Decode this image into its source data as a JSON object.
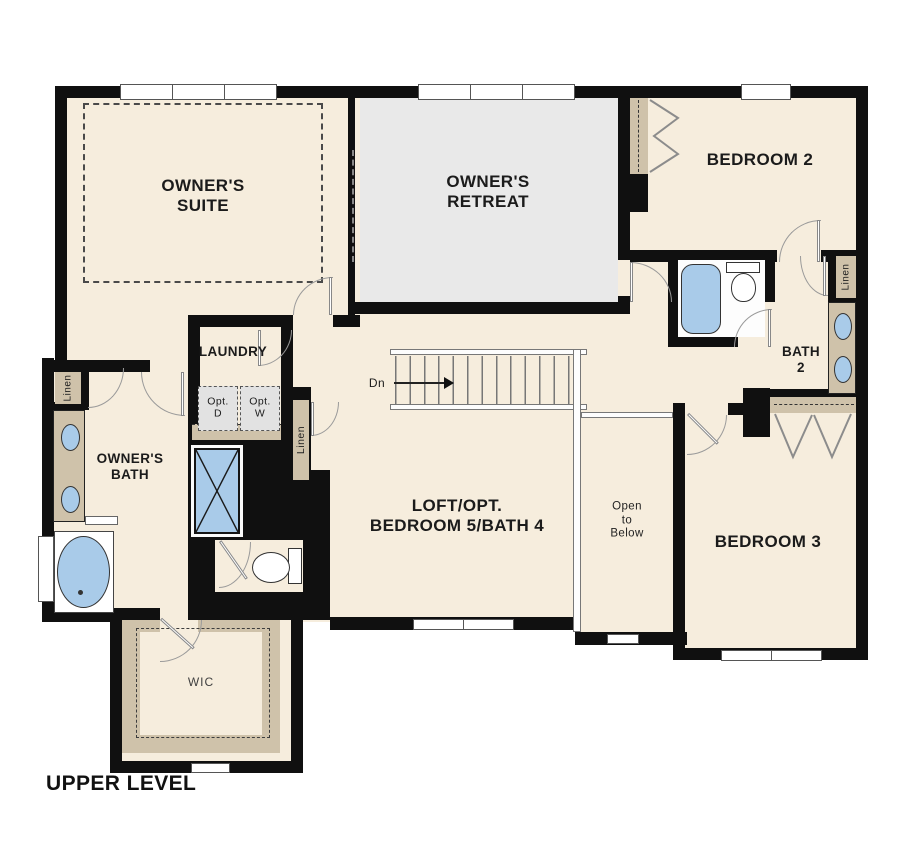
{
  "title": "UPPER LEVEL",
  "rooms": {
    "owners_suite": {
      "lines": [
        "OWNER'S",
        "SUITE"
      ]
    },
    "owners_retreat": {
      "lines": [
        "OWNER'S",
        "RETREAT"
      ]
    },
    "bedroom_2": {
      "lines": [
        "BEDROOM 2"
      ]
    },
    "bedroom_3": {
      "lines": [
        "BEDROOM 3"
      ]
    },
    "loft_opt": {
      "lines": [
        "LOFT/OPT.",
        "BEDROOM 5/BATH 4"
      ]
    },
    "laundry": {
      "lines": [
        "LAUNDRY"
      ]
    },
    "owners_bath": {
      "lines": [
        "OWNER'S",
        "BATH"
      ]
    },
    "bath_2": {
      "lines": [
        "BATH",
        "2"
      ]
    },
    "open_to_below": {
      "lines": [
        "Open",
        "to",
        "Below"
      ]
    },
    "wic": {
      "lines": [
        "WIC"
      ]
    }
  },
  "annotations": {
    "stair_direction": "Dn",
    "linen_closet": "Linen",
    "opt_dryer": {
      "lines": [
        "Opt.",
        "D"
      ]
    },
    "opt_washer": {
      "lines": [
        "Opt.",
        "W"
      ]
    }
  },
  "colors": {
    "wall": "#101010",
    "floor": "#f6eddd",
    "retreat_floor": "#e9e9e9",
    "cabinetry": "#cfc2aa",
    "fixtures": "#a9cbe9",
    "background": "#ffffff"
  }
}
